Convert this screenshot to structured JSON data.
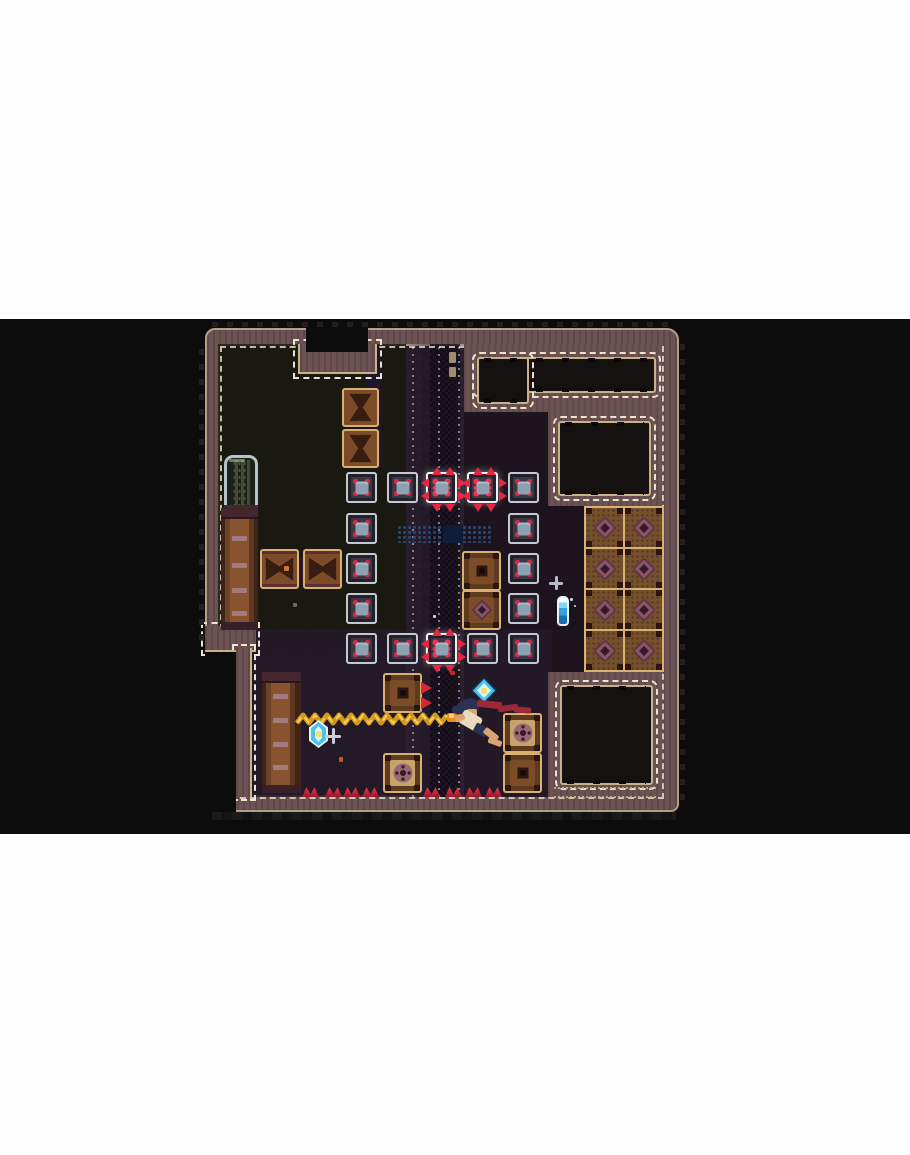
{
  "meta": {
    "scene": "pixel-art roguelite room, letterboxed game frame",
    "text_visible": "none"
  },
  "colors": {
    "outside": "#0c0c0c",
    "wall": "#6d5254",
    "tanOuter": "#b3a084",
    "tanInner": "#c9b28a",
    "dash": "#ece4d0",
    "alcove": "#141110",
    "floorBase": "#1f1722",
    "knob": "#2a160e",
    "steelBg": "#23202a",
    "steelBorder": "#c3c9d3",
    "steelBorderHot": "#eef1f4",
    "steelPanel": "#3d3744",
    "steelCore": "#8fa0b0",
    "red": "#d62a4a",
    "redHot": "#f23056",
    "spike": "#e32744",
    "crateTan": "#d8b170",
    "crateBrown": "#7c4b27",
    "crateDark": "#371d12",
    "trailGold": "#d2991e",
    "trailHi": "#f6d058",
    "gemCyan": "#49c3ea",
    "gemWhite": "#dff6ff",
    "gemNavy": "#15325a",
    "scarfRed": "#9e2838",
    "skin": "#d8a473",
    "shirt": "#ead9bd",
    "hair": "#2b3150"
  },
  "layout": {
    "page": {
      "w": 910,
      "h": 1155
    },
    "band": {
      "x": 0,
      "y": 319,
      "w": 910,
      "h": 515
    },
    "room": {
      "x": 205,
      "y": 328,
      "w": 474,
      "h": 484
    },
    "floor": {
      "x": 218,
      "y": 344,
      "w": 444,
      "h": 453
    },
    "floor_dash": {
      "x": 220,
      "y": 346,
      "w": 440,
      "h": 449
    },
    "teeth": [
      [
        212,
        322,
        460,
        5,
        "h"
      ],
      [
        212,
        813,
        464,
        5,
        "h"
      ],
      [
        199,
        340,
        5,
        300,
        "v"
      ],
      [
        680,
        340,
        5,
        460,
        "v"
      ]
    ],
    "bottom_shadow": [
      212,
      812,
      464,
      8
    ]
  },
  "structures": {
    "tints": [
      {
        "r": [
          218,
          344,
          188,
          306
        ],
        "color": "#181a0f",
        "op": 0.9
      },
      {
        "r": [
          464,
          344,
          198,
          453
        ],
        "color": "#1c131c",
        "op": 0.85
      },
      {
        "r": [
          252,
          630,
          300,
          167
        ],
        "color": "#241a28",
        "op": 0.9
      },
      {
        "r": [
          366,
          350,
          16,
          118
        ],
        "color": "#1d1530",
        "op": 0.9
      }
    ],
    "corridor": {
      "r": [
        406,
        344,
        58,
        453
      ],
      "checker": [
        430,
        344,
        30,
        453
      ],
      "dotted_x": [
        412,
        438,
        458
      ],
      "door_marks": [
        [
          449,
          352,
          7,
          11
        ],
        [
          449,
          367,
          7,
          10
        ]
      ]
    },
    "notch": {
      "wall": [
        298,
        344,
        79,
        30
      ],
      "black": [
        306,
        319,
        62,
        33
      ]
    },
    "lower_left": {
      "ledge": [
        205,
        626,
        51,
        26
      ],
      "wall": [
        236,
        648,
        16,
        149
      ],
      "outside": [
        205,
        652,
        31,
        160
      ]
    },
    "alcoves": [
      {
        "name": "alcove-top-right",
        "panel": [
          464,
          344,
          198,
          68
        ],
        "dark": [
          [
            477,
            357,
            179,
            36
          ],
          [
            477,
            357,
            52,
            47
          ]
        ],
        "seam": [
          479,
          376,
          48,
          15
        ]
      },
      {
        "name": "alcove-right",
        "panel": [
          548,
          410,
          114,
          96
        ],
        "dark": [
          [
            558,
            421,
            93,
            75
          ]
        ]
      },
      {
        "name": "alcove-bottom-right",
        "panel": [
          548,
          672,
          114,
          125
        ],
        "dark": [
          [
            560,
            685,
            93,
            100
          ]
        ],
        "scallop": [
          554,
          787,
          102,
          7
        ]
      }
    ],
    "grid_tiles": {
      "x": 584,
      "y": 506,
      "cols": 2,
      "rows": 4,
      "w": 39,
      "h": 41
    },
    "cage": {
      "r": [
        224,
        455,
        34,
        55
      ],
      "sill": [
        224,
        505,
        34,
        6
      ]
    },
    "pillars": [
      {
        "r": [
          221,
          508,
          37,
          122
        ],
        "slats": [
          28,
          55,
          80,
          103
        ]
      },
      {
        "r": [
          262,
          672,
          39,
          121
        ],
        "slats": [
          22,
          46,
          70,
          93
        ]
      }
    ],
    "ghost_band": {
      "r": [
        397,
        525,
        95,
        18
      ],
      "core": [
        443,
        525,
        20,
        18
      ]
    }
  },
  "tiles": {
    "steel_blocks": [
      [
        346,
        472,
        0
      ],
      [
        387,
        472,
        0
      ],
      [
        426,
        472,
        1
      ],
      [
        467,
        472,
        1
      ],
      [
        508,
        472,
        0
      ],
      [
        346,
        513,
        0
      ],
      [
        508,
        513,
        0
      ],
      [
        346,
        553,
        0
      ],
      [
        508,
        553,
        0
      ],
      [
        346,
        593,
        0
      ],
      [
        508,
        593,
        0
      ],
      [
        346,
        633,
        0
      ],
      [
        387,
        633,
        0
      ],
      [
        426,
        633,
        1
      ],
      [
        467,
        633,
        0
      ],
      [
        508,
        633,
        0
      ]
    ],
    "steel_size": 31,
    "crates_v": [
      [
        342,
        388
      ],
      [
        342,
        429
      ]
    ],
    "crates_h": [
      [
        260,
        549
      ],
      [
        303,
        549
      ]
    ],
    "crate_connector": [
      296,
      557,
      10,
      24
    ],
    "crate_dot": [
      284,
      566,
      5,
      5
    ],
    "panel_crates": [
      [
        462,
        551,
        "vA"
      ],
      [
        462,
        590,
        "vC"
      ],
      [
        383,
        673,
        "vA"
      ],
      [
        383,
        753,
        "vB"
      ],
      [
        503,
        713,
        "vB"
      ],
      [
        503,
        753,
        "vA"
      ]
    ],
    "panel_size": [
      39,
      40
    ],
    "floor_spikes_x": [
      302,
      325,
      343,
      362,
      423,
      445,
      465,
      485
    ],
    "floor_spikes_y": 786,
    "crate_spikes": [
      [
        421,
        681
      ],
      [
        421,
        696
      ]
    ]
  },
  "entities": {
    "trail": {
      "x1": 297,
      "x2": 449,
      "y": 719,
      "amp": 4,
      "period": 12,
      "tip": [
        447,
        713,
        14,
        9
      ]
    },
    "gems": [
      {
        "name": "gem-pickup-large",
        "r": [
          471,
          677,
          26,
          27
        ],
        "shape": "clip-diamond"
      },
      {
        "name": "gem-pickup-small",
        "r": [
          309,
          720,
          19,
          28
        ],
        "shape": "clip-hex"
      }
    ],
    "potion": [
      557,
      596,
      12,
      30
    ],
    "potion_specks": [
      [
        570,
        598,
        3,
        3
      ],
      [
        574,
        605,
        2,
        2
      ]
    ],
    "sparkles": [
      {
        "r": [
          549,
          576,
          14,
          14
        ],
        "color": "#b8bcc8"
      },
      {
        "r": [
          325,
          728,
          16,
          16
        ],
        "color": "#c8ccd4"
      }
    ],
    "specks": [
      [
        293,
        603,
        4,
        4,
        "#6c6a56"
      ],
      [
        433,
        615,
        3,
        3,
        "#d8d8c8"
      ],
      [
        339,
        757,
        4,
        5,
        "#c05a28"
      ],
      [
        450,
        671,
        5,
        4,
        "#b82828"
      ]
    ],
    "player": {
      "name": "player-character",
      "parts": [
        [
          "player-hair",
          "hair",
          456,
          699,
          22,
          14,
          -15,
          "50% 40% 10% 30%"
        ],
        [
          "player-hair-tuft",
          "hair",
          452,
          706,
          10,
          8,
          20,
          "40%"
        ],
        [
          "player-face",
          "skin",
          467,
          709,
          10,
          9,
          0,
          "2px"
        ],
        [
          "player-scarf",
          "scarfRed",
          477,
          701,
          25,
          7,
          6,
          "2px"
        ],
        [
          "player-scarf",
          "scarfRed",
          498,
          705,
          20,
          6,
          -8,
          "2px"
        ],
        [
          "player-scarf",
          "scarfRed",
          514,
          707,
          17,
          6,
          4,
          "2px"
        ],
        [
          "player-torso",
          "shirt",
          460,
          713,
          21,
          15,
          30,
          "3px"
        ],
        [
          "player-arm",
          "skin",
          455,
          715,
          10,
          6,
          -20,
          "2px"
        ],
        [
          "player-shorts",
          "hair",
          474,
          725,
          14,
          10,
          28,
          "2px"
        ],
        [
          "player-leg",
          "skin",
          483,
          731,
          16,
          7,
          38,
          "2px"
        ],
        [
          "player-leg",
          "skin",
          488,
          739,
          14,
          6,
          20,
          "2px"
        ]
      ]
    }
  }
}
